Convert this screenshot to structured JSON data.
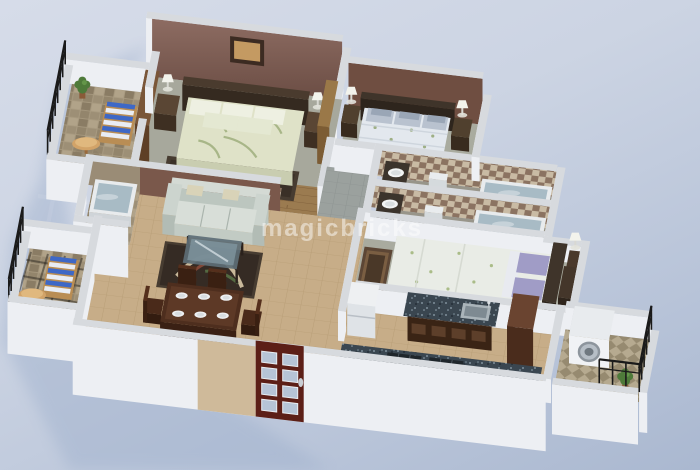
{
  "watermark": {
    "text": "magicbricks"
  },
  "scene": {
    "kind": "3D isometric floor plan render",
    "property_type": "3 BHK apartment with hall, kitchen, utility and balconies",
    "rooms": [
      {
        "name": "master-bedroom",
        "items": [
          "double-bed",
          "pillows",
          "headboard",
          "nightstand-left",
          "nightstand-right",
          "table-lamps",
          "wardrobe",
          "wooden-side-cabinet",
          "picture-frame",
          "area-rug",
          "ottoman-stools",
          "wood-floor-strip"
        ]
      },
      {
        "name": "bedroom-2",
        "items": [
          "double-bed",
          "grey-pillows",
          "headboard",
          "nightstand-left",
          "nightstand-right",
          "table-lamps",
          "rug"
        ]
      },
      {
        "name": "bedroom-3",
        "items": [
          "double-bed",
          "lavender-pillows",
          "headboard",
          "side-cabinet",
          "table-lamp",
          "wardrobe",
          "rug"
        ]
      },
      {
        "name": "living-room",
        "items": [
          "three-seat-sofa",
          "cushions",
          "glass-coffee-table",
          "swirl-area-rug"
        ]
      },
      {
        "name": "dining-area",
        "items": [
          "dining-table",
          "six-chairs",
          "place-settings"
        ]
      },
      {
        "name": "kitchen",
        "items": [
          "refrigerator",
          "island-counter",
          "steel-sink",
          "gas-hobs",
          "granite-counter",
          "tall-cabinet"
        ]
      },
      {
        "name": "master-bathroom",
        "items": [
          "bathtub"
        ]
      },
      {
        "name": "bathroom-2",
        "items": [
          "vanity-washbasin",
          "toilet",
          "bathtub",
          "checkered-tile-walls"
        ]
      },
      {
        "name": "bathroom-3",
        "items": [
          "vanity-washbasin",
          "toilet",
          "bathtub",
          "checkered-tile-walls"
        ]
      },
      {
        "name": "balcony-1",
        "items": [
          "striped-deck-chair",
          "round-table",
          "potted-plant",
          "metal-railing"
        ]
      },
      {
        "name": "balcony-2",
        "items": [
          "striped-deck-chair",
          "round-table",
          "metal-railing",
          "pergola-shadow"
        ]
      },
      {
        "name": "utility-balcony",
        "items": [
          "washing-machine",
          "metal-railing",
          "potted-plant"
        ]
      },
      {
        "name": "entrance",
        "items": [
          "glass-panel-door",
          "door-handle"
        ]
      }
    ]
  },
  "colors": {
    "sky_top": "#d6dce9",
    "sky_bottom": "#aab8d0",
    "wall_face": "#edeff3",
    "wall_top": "#d7dade",
    "accent_master": "#85645a",
    "accent_bedroom2": "#6f4e41",
    "accent_living": "#7a584b",
    "floor_master": "#a7a89c",
    "floor_bedroom": "#a9ab9f",
    "floor_corridor": "#9ba19e",
    "floor_bath": "#98958a",
    "floor_tan": "#c7ad88",
    "wood": "#9b7b50",
    "rug_dark": "#473c31",
    "sofa": "#cdd4cf",
    "cushion": "#d9d3b8",
    "bed_master": "#dfe2c8",
    "bed_blue": "#e3e8ee",
    "bed_white": "#e9ece6",
    "pillow_lavender": "#a09cc6",
    "dark_wood": "#4a2c1e",
    "walnut": "#4a3020",
    "granite": "#3a4650",
    "steel": "#b9c2c8",
    "door_maroon": "#5c1f17",
    "glass": "#b6c4d6",
    "tub_water": "#a8bbc5",
    "porcelain": "#f2f4f4",
    "railing": "#1a1a1a",
    "stripe_blue": "#3e68c6",
    "watermark": "#ffffff",
    "shadow": "#9fb0cc"
  }
}
